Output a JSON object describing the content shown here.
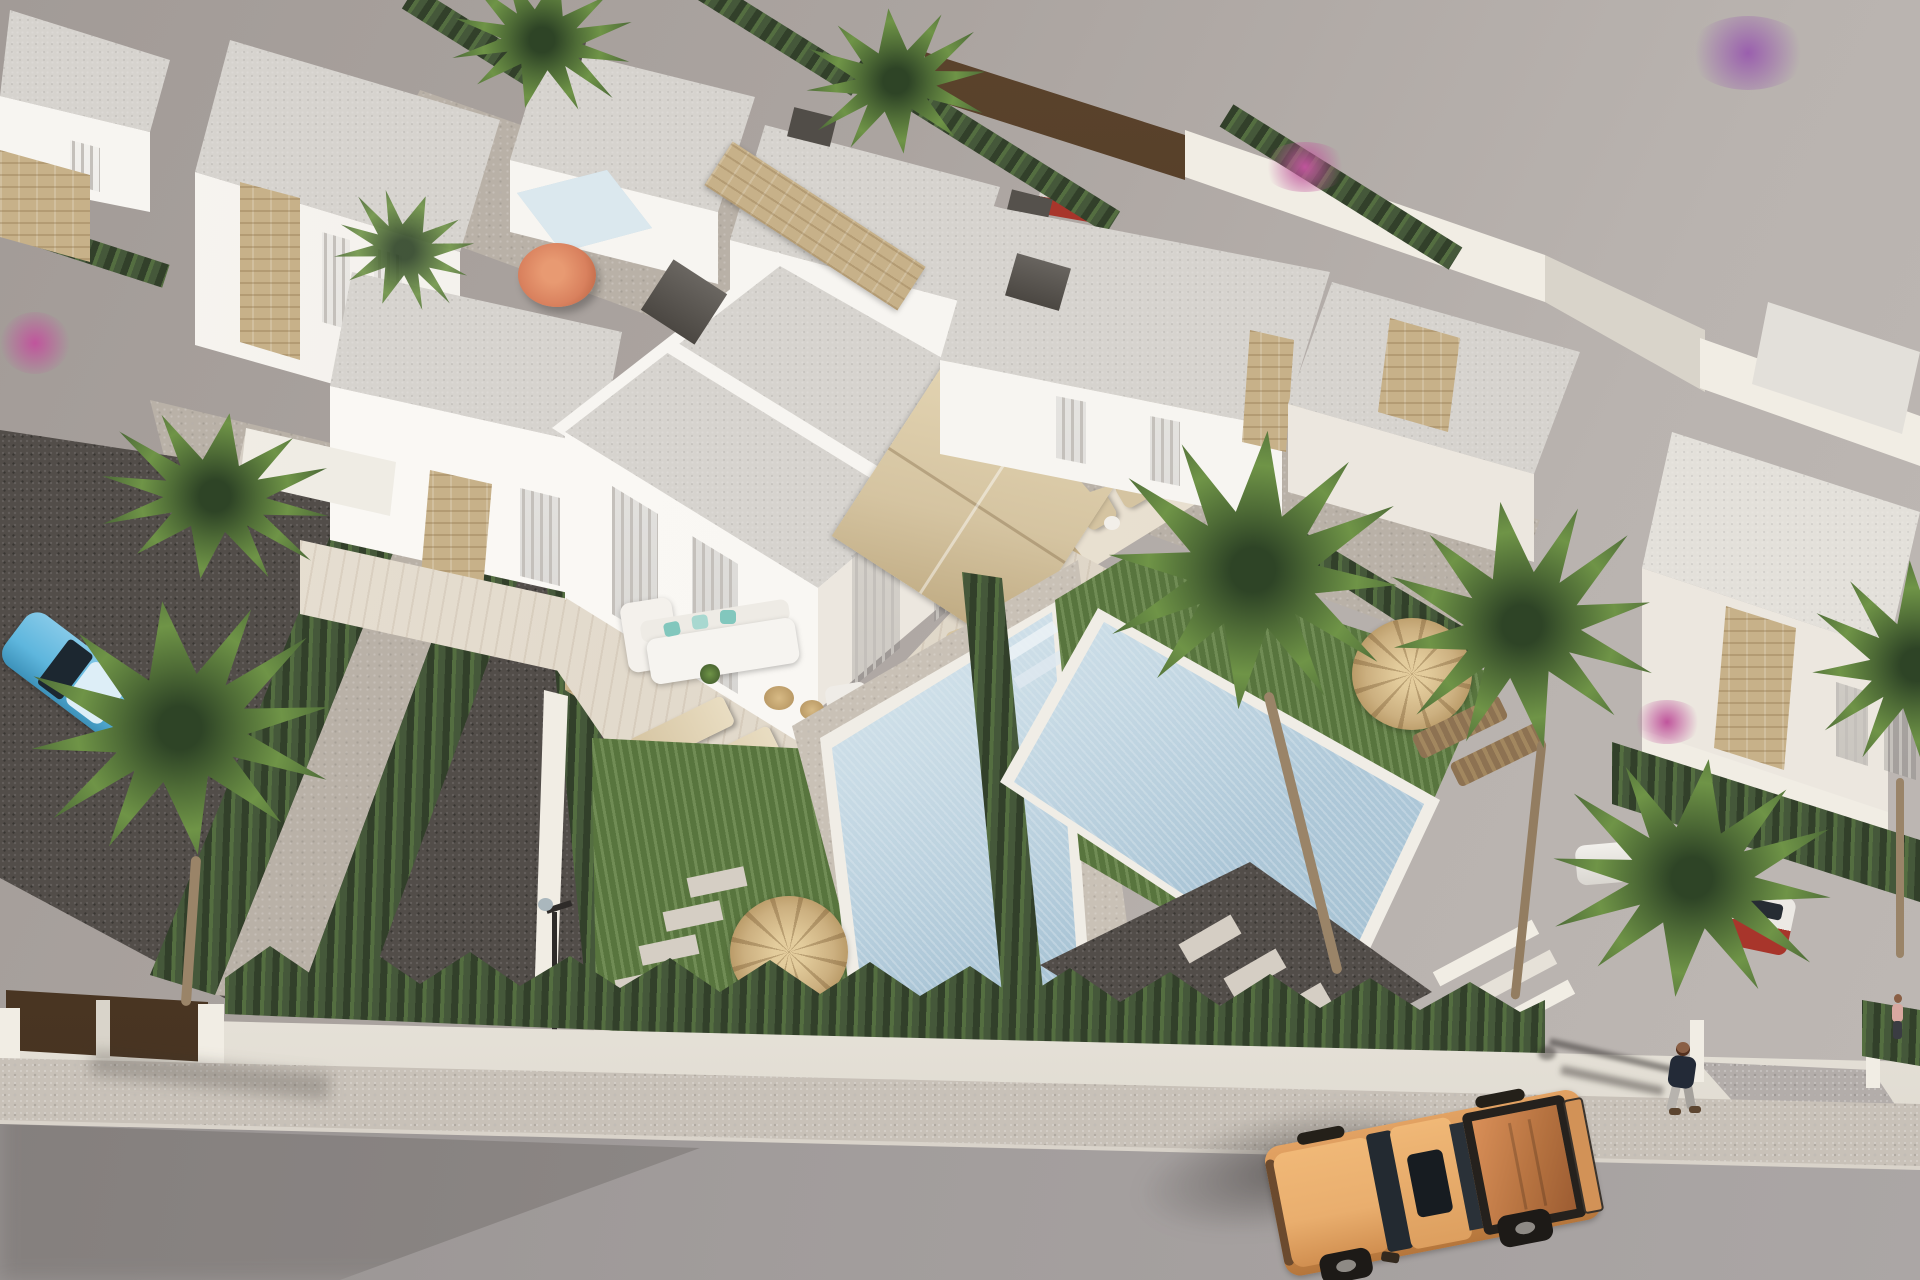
{
  "scene": {
    "type": "3d-architectural-rendering",
    "view": "aerial high-angle",
    "description": "New-build Mediterranean residential development of white flat-roof villas with private pools, hedged gardens and palm trees; a street with sidewalk runs along the bottom where an orange pickup truck drives past a walking pedestrian",
    "time_of_day": "sunny daytime",
    "objects": [
      {
        "name": "duplex-villa",
        "note": "central two-storey white villa with stone cladding, tall curtained windows and roof terrace"
      },
      {
        "name": "background-villas",
        "note": "rows of white flat-roof villas with dark chimney caps receding to the upper left"
      },
      {
        "name": "neighbor-villa-right",
        "note": "white villa on the right plot with stone chimney"
      },
      {
        "name": "far-right-villa",
        "note": "partially visible villa at right edge with stone facade band"
      },
      {
        "name": "main-pool",
        "note": "mosaic-tiled private pool with beach-entry steps"
      },
      {
        "name": "neighbor-pool",
        "note": "second private pool on the right plot"
      },
      {
        "name": "small-back-pool",
        "note": "small pool with orange parasol in a background garden"
      },
      {
        "name": "lawn",
        "note": "green grass patches around the pools"
      },
      {
        "name": "straw-parasol",
        "note": "three wicker straw parasols with sun loungers"
      },
      {
        "name": "beige-parasol",
        "note": "square canvas parasol over the terrace dining set"
      },
      {
        "name": "outdoor-sofa",
        "note": "white lounge sofa with teal cushions on the deck terrace"
      },
      {
        "name": "balcony-seating",
        "note": "wicker chairs on the first-floor balcony"
      },
      {
        "name": "stepping-stones",
        "note": "white pad walkways across gravel and grass"
      },
      {
        "name": "garden-lamp",
        "note": "small dark garden lamp post near the entrance path"
      },
      {
        "name": "hedges",
        "note": "clipped conifer hedges dividing every plot"
      },
      {
        "name": "palm-trees",
        "note": "fan palms scattered across the gardens"
      },
      {
        "name": "bougainvillea",
        "note": "pink and purple flowering shrubs"
      },
      {
        "name": "perimeter-wall",
        "note": "low white boundary wall along the street"
      },
      {
        "name": "wooden-gate",
        "note": "dark brown entrance gate at lower left"
      },
      {
        "name": "driveway-opening",
        "note": "gated driveway ramp at lower right"
      },
      {
        "name": "sidewalk",
        "note": "beige pavement strip between wall and road"
      },
      {
        "name": "road",
        "note": "wide asphalt street across the bottom"
      },
      {
        "name": "pickup-truck",
        "note": "orange double-cab pickup with open bed driving on the road"
      },
      {
        "name": "pedestrian",
        "note": "person in dark jacket walking along the street"
      },
      {
        "name": "distant-person",
        "note": "small figure near the driveway at far right"
      },
      {
        "name": "blue-car",
        "note": "light blue car parked on the left gravel drive"
      },
      {
        "name": "red-car",
        "note": "red car glimpsed behind the back fence"
      },
      {
        "name": "white-car",
        "note": "white car behind the right hedge"
      },
      {
        "name": "gravel-yards",
        "note": "dark decorative gravel surfaces"
      }
    ]
  },
  "palette": {
    "ground": "#aba4a0",
    "ground_light": "#b9b3af",
    "road": "#a19c9b",
    "road_shadow": "#807b7a",
    "sidewalk": "#c8c1b8",
    "curb": "#d9d3ca",
    "wall": "#f1ede4",
    "wall_shade": "#d9d4ca",
    "gate_wood": "#44311f",
    "hedge": "#45583a",
    "hedge_light": "#5d7546",
    "grass": "#607f43",
    "grass_light": "#739552",
    "pool_water": "#b6cedd",
    "pool_shallow": "#dbe8ee",
    "pool_deep": "#8fb0c5",
    "pool_rim": "#f0ede6",
    "villa": "#f7f5f1",
    "villa_cream": "#ece7df",
    "villa_shadow": "#cecbc5",
    "roof": "#d6d3ce",
    "roof_light": "#e3e0da",
    "stone": "#c7b189",
    "stone_dark": "#ab9166",
    "glass": "#63605c",
    "curtain": "#c4c0bb",
    "deck": "#e3d9c8",
    "gravel": "#524d49",
    "path": "#b9b1a7",
    "pad": "#d5cec4",
    "straw": "#ccb080",
    "canvas": "#d5c4a1",
    "canvas_dark": "#bda87f",
    "wood": "#8d7252",
    "palm": "#6f9447",
    "truck_body": "#d2914f",
    "truck_hood": "#e9ae6e",
    "truck_bed": "#b4713f",
    "truck_dark": "#25211d",
    "car_blue": "#5eb6dd",
    "car_red": "#a8352b",
    "umbrella_orange": "#d9815e",
    "flower_pink": "#c0559c",
    "flower_purple": "#9a5fae",
    "person_dark": "#232a37",
    "person_pants": "#b7b3ae",
    "skin": "#8a5f45",
    "teal": "#82c7bd"
  }
}
